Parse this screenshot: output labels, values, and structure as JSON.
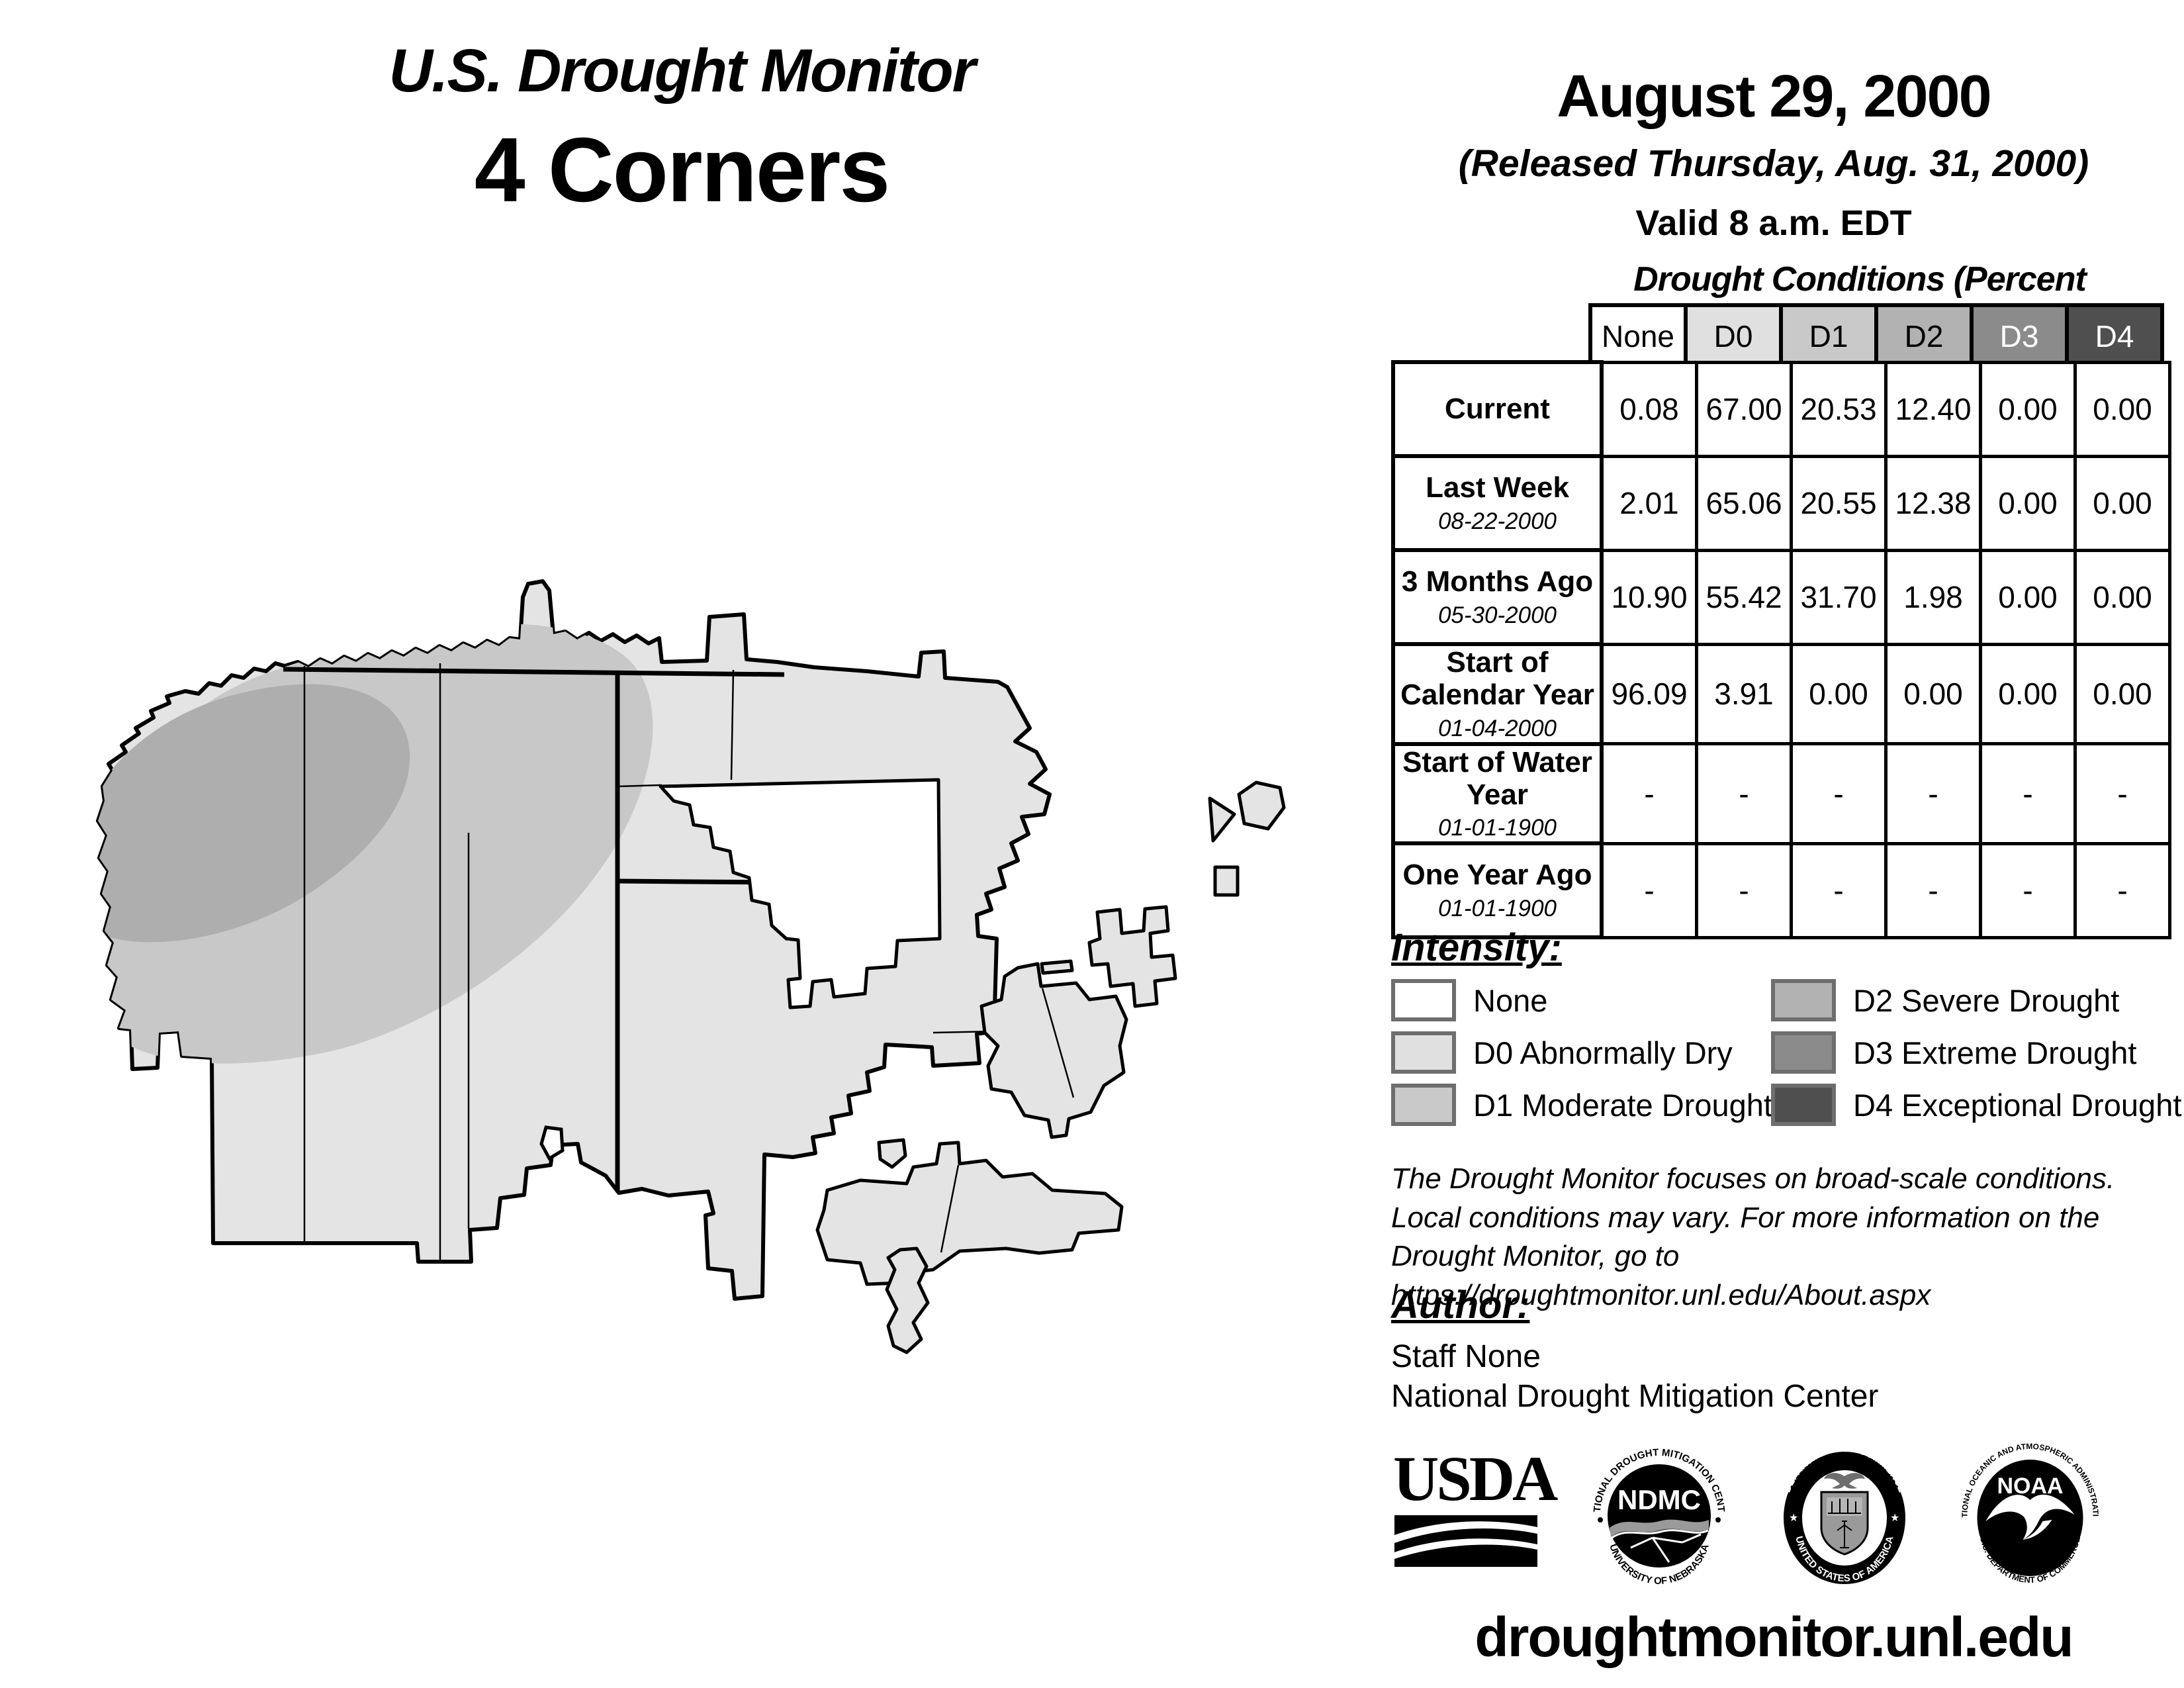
{
  "header": {
    "title_line1": "U.S. Drought Monitor",
    "title_line2": "4 Corners",
    "date": "August 29, 2000",
    "released": "(Released Thursday, Aug. 31, 2000)",
    "valid": "Valid 8 a.m. EDT"
  },
  "table": {
    "title": "Drought Conditions (Percent Area)",
    "columns": [
      "None",
      "D0",
      "D1",
      "D2",
      "D3",
      "D4"
    ],
    "rows": [
      {
        "label": "Current",
        "sublabel": "",
        "values": [
          "0.08",
          "67.00",
          "20.53",
          "12.40",
          "0.00",
          "0.00"
        ]
      },
      {
        "label": "Last Week",
        "sublabel": "08-22-2000",
        "values": [
          "2.01",
          "65.06",
          "20.55",
          "12.38",
          "0.00",
          "0.00"
        ]
      },
      {
        "label": "3 Months Ago",
        "sublabel": "05-30-2000",
        "values": [
          "10.90",
          "55.42",
          "31.70",
          "1.98",
          "0.00",
          "0.00"
        ]
      },
      {
        "label": "Start of Calendar Year",
        "sublabel": "01-04-2000",
        "values": [
          "96.09",
          "3.91",
          "0.00",
          "0.00",
          "0.00",
          "0.00"
        ]
      },
      {
        "label": "Start of Water Year",
        "sublabel": "01-01-1900",
        "values": [
          "-",
          "-",
          "-",
          "-",
          "-",
          "-"
        ]
      },
      {
        "label": "One Year Ago",
        "sublabel": "01-01-1900",
        "values": [
          "-",
          "-",
          "-",
          "-",
          "-",
          "-"
        ]
      }
    ]
  },
  "legend": {
    "heading": "Intensity:",
    "items": [
      {
        "label": "None",
        "color": "#ffffff"
      },
      {
        "label": "D0 Abnormally Dry",
        "color": "#e0e0e0"
      },
      {
        "label": "D1 Moderate Drought",
        "color": "#c9c9c9"
      },
      {
        "label": "D2 Severe Drought",
        "color": "#b2b2b2"
      },
      {
        "label": "D3 Extreme Drought",
        "color": "#8b8b8b"
      },
      {
        "label": "D4 Exceptional Drought",
        "color": "#4f4f4f"
      }
    ]
  },
  "disclaimer": {
    "line1": "The Drought Monitor focuses on broad-scale conditions.",
    "line2": "Local conditions may vary. For more information on the",
    "line3": "Drought Monitor, go to https://droughtmonitor.unl.edu/About.aspx"
  },
  "author": {
    "heading": "Author:",
    "name": "Staff None",
    "org": "National Drought Mitigation Center"
  },
  "logos": {
    "usda_text": "USDA",
    "ndmc_center": "NDMC",
    "ndmc_ring_top": "NATIONAL DROUGHT MITIGATION CENTER",
    "ndmc_ring_bottom": "UNIVERSITY OF NEBRASKA",
    "doc_ring_top": "DEPARTMENT OF COMMERCE",
    "doc_ring_bottom": "UNITED STATES OF AMERICA",
    "noaa_center": "NOAA",
    "noaa_ring_top": "NATIONAL OCEANIC AND ATMOSPHERIC ADMINISTRATION",
    "noaa_ring_bottom": "U.S. DEPARTMENT OF COMMERCE"
  },
  "footer": {
    "url": "droughtmonitor.unl.edu"
  },
  "map": {
    "colors": {
      "none": "#ffffff",
      "d0": "#e4e4e4",
      "d1": "#c8c8c8",
      "d2": "#aeaeae",
      "outline": "#000000"
    }
  }
}
